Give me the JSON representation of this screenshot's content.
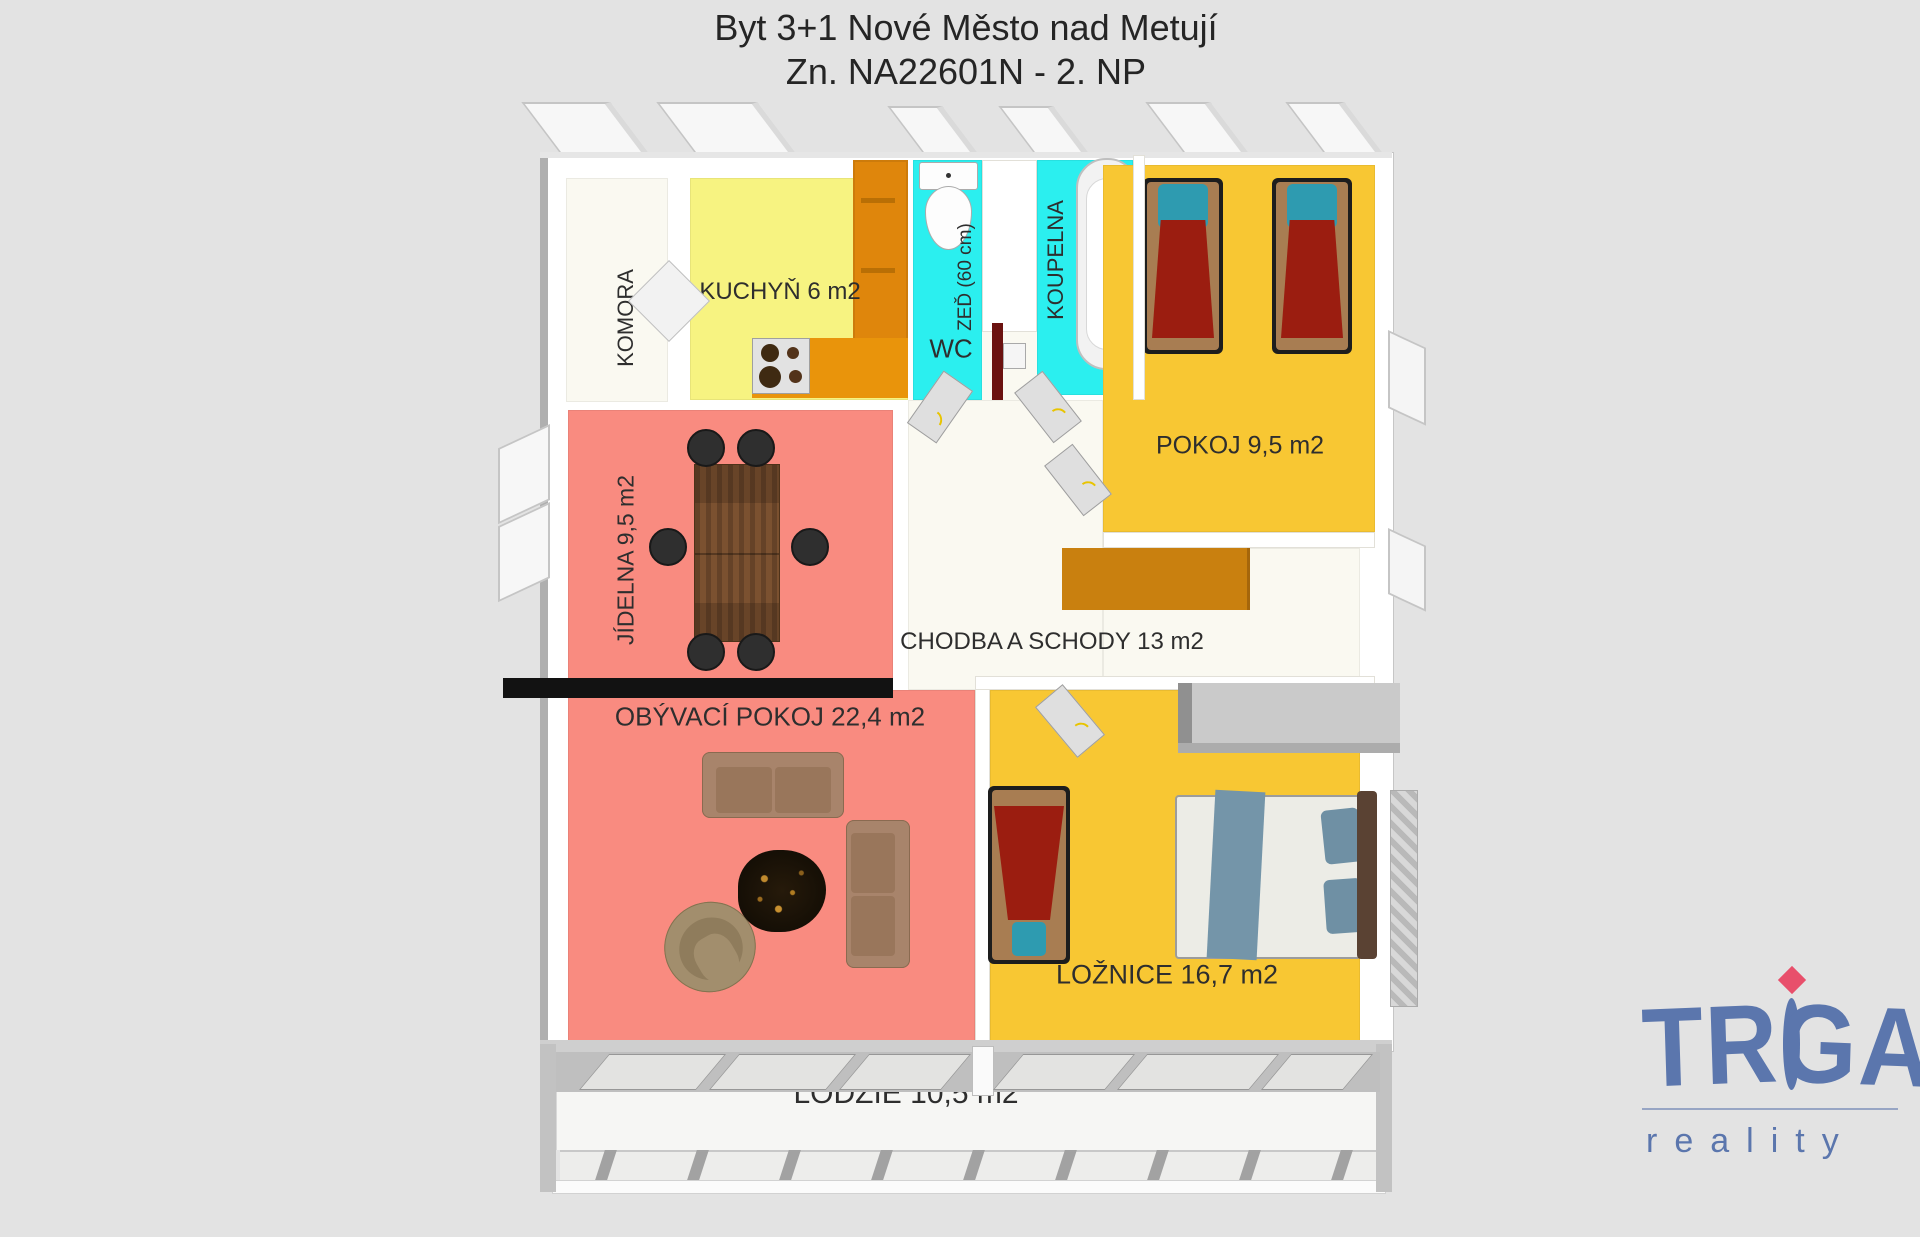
{
  "title": {
    "line1": "Byt 3+1 Nové Město nad Metují",
    "line2": "Zn. NA22601N - 2. NP"
  },
  "rooms": {
    "komora": {
      "label": "KOMORA"
    },
    "kuchyn": {
      "label": "KUCHYŇ 6 m2"
    },
    "wc": {
      "label": "WC"
    },
    "zed": {
      "label": "ZEĎ (60 cm)"
    },
    "koupelna": {
      "label": "KOUPELNA"
    },
    "pokoj": {
      "label": "POKOJ 9,5 m2"
    },
    "jidelna": {
      "label": "JÍDELNA 9,5 m2"
    },
    "chodba": {
      "label": "CHODBA A SCHODY 13 m2"
    },
    "obyvak": {
      "label": "OBÝVACÍ POKOJ 22,4 m2"
    },
    "loznice": {
      "label": "LOŽNICE 16,7 m2"
    },
    "lodzie": {
      "label": "LODŽIE 10,5 m2"
    }
  },
  "logo": {
    "brand": "TRIGA",
    "brand_left": "TR",
    "brand_right": "GA",
    "tagline": "reality"
  },
  "colors": {
    "bg": "#E3E3E3",
    "floor_white": "#FAF9F1",
    "kitchen_yellow": "#F7F381",
    "cyan": "#2BEFEF",
    "golden": "#F8C733",
    "salmon": "#F98B80",
    "orange_cabinet": "#DF860C",
    "orange_counter": "#E9940B",
    "stairs_orange": "#C9800F",
    "blanket_red": "#9B1D10",
    "pillow_teal": "#2E9BB0",
    "bed_brown": "#A87D52",
    "duvet_white": "#ECECE6",
    "denim_blue": "#7495A9",
    "sofa_tan": "#A8846B",
    "wood_brown": "#7B5130",
    "logo_blue": "#5B76AD",
    "logo_red": "#E84F6B"
  }
}
